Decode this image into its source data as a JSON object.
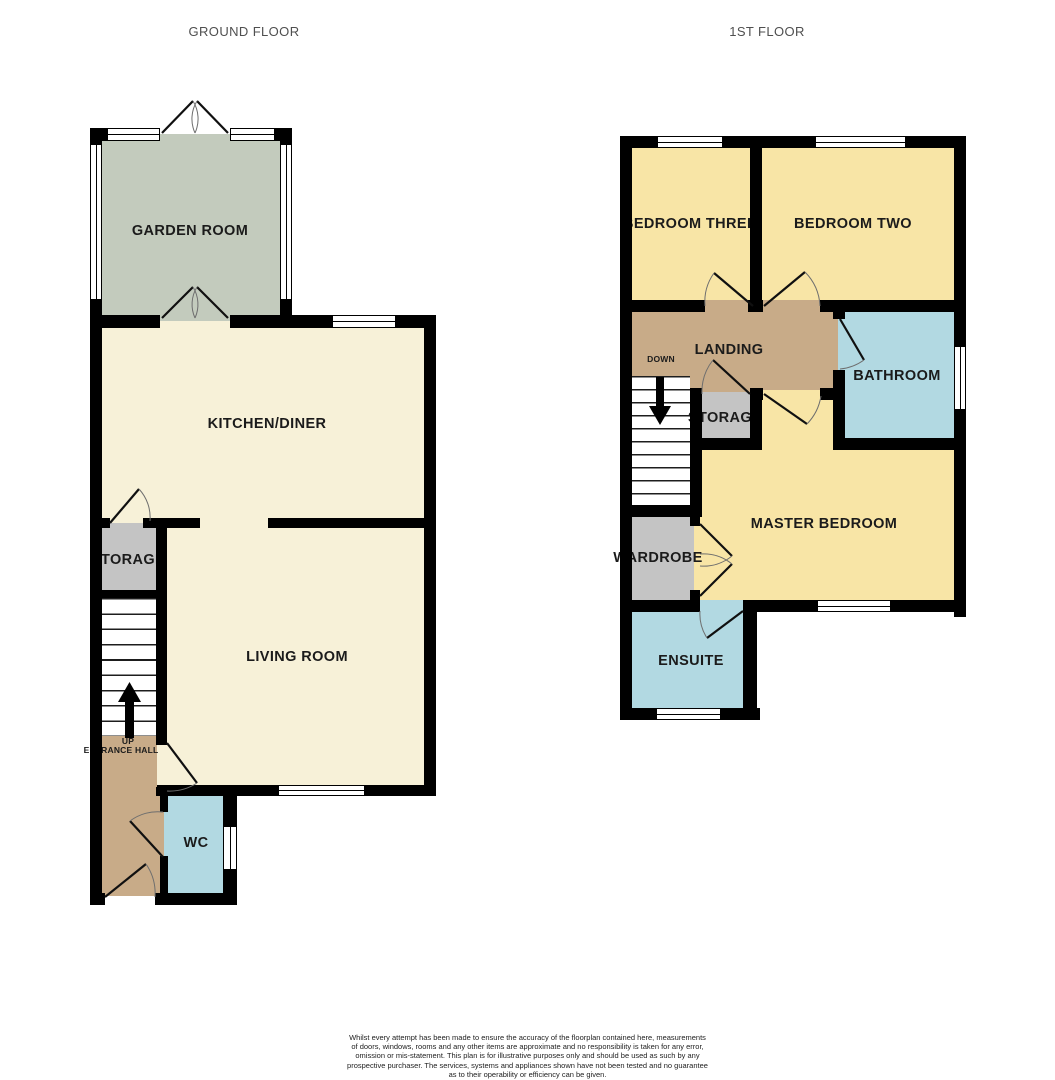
{
  "titles": {
    "ground": "GROUND FLOOR",
    "first": "1ST FLOOR"
  },
  "ground": {
    "rooms": {
      "garden_room": "GARDEN ROOM",
      "kitchen_diner": "KITCHEN/DINER",
      "storage": "STORAGE",
      "living_room": "LIVING ROOM",
      "up": "UP",
      "entrance_hall": "ENTRANCE HALL",
      "wc": "WC"
    }
  },
  "first": {
    "rooms": {
      "bedroom_three": "BEDROOM THREE",
      "bedroom_two": "BEDROOM TWO",
      "landing": "LANDING",
      "down": "DOWN",
      "bathroom": "BATHROOM",
      "storage": "STORAGE",
      "master_bedroom": "MASTER BEDROOM",
      "wardrobe": "WARDROBE",
      "ensuite": "ENSUITE"
    }
  },
  "icons": {
    "up_arrow": "up-arrow-icon",
    "down_arrow": "down-arrow-icon"
  },
  "colors": {
    "wall": "#000000",
    "room_cream": "#f7f1d8",
    "room_yellow": "#f8e5a6",
    "room_sage": "#c3cbbd",
    "room_tan": "#c8ab88",
    "room_blue": "#b2d9e2",
    "room_gray": "#c4c4c4",
    "title_text": "#4f4f4f",
    "label_text": "#1b1b1b"
  },
  "disclaimer": {
    "lines": [
      "Whilst every attempt has been made to ensure the accuracy of the floorplan contained here, measurements",
      "of doors, windows, rooms and any other items are approximate and no responsibility is taken for any error,",
      "omission or mis-statement. This plan is for illustrative purposes only and should be used as such by any",
      "prospective purchaser. The services, systems and appliances shown have not been tested and no guarantee",
      "as to their operability or efficiency can be given.",
      "Made with Metropix ©2025"
    ]
  }
}
